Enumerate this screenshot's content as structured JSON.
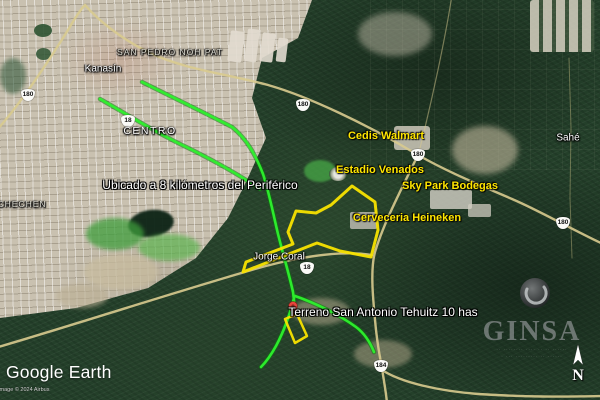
{
  "colors": {
    "route_green": "#2ef22e",
    "parcel_yellow": "#f8e300",
    "poi_label_yellow": "#ffe600",
    "road_tan": "#d9cb8f",
    "marker_red": "#e8453c"
  },
  "place_labels": [
    {
      "id": "san-pedro-noh-pat",
      "text": "SAN PEDRO NOH PAT"
    },
    {
      "id": "kanasin",
      "text": "Kanasín"
    },
    {
      "id": "centro",
      "text": "CENTRO"
    },
    {
      "id": "chechen",
      "text": "CHECHEN"
    },
    {
      "id": "sahe",
      "text": "Sahé"
    },
    {
      "id": "jorge-coral",
      "text": "Jorge Coral"
    }
  ],
  "poi_labels": [
    {
      "id": "cedis-walmart",
      "text": "Cedis Walmart"
    },
    {
      "id": "estadio-venados",
      "text": "Estadio Venados"
    },
    {
      "id": "sky-park-bodegas",
      "text": "Sky Park Bodegas"
    },
    {
      "id": "cerveceria-heineken",
      "text": "Cerveceria Heineken"
    }
  ],
  "annotations": [
    {
      "id": "periferico-note",
      "text": "Ubicado a 8 kilómetros del Periférico"
    },
    {
      "id": "terreno-note",
      "text": "Terreno San Antonio Tehuitz 10 has"
    }
  ],
  "road_shields": [
    {
      "route": "180"
    },
    {
      "route": "180"
    },
    {
      "route": "180"
    },
    {
      "route": "180"
    },
    {
      "route": "18"
    },
    {
      "route": "18"
    },
    {
      "route": "184"
    }
  ],
  "attribution": {
    "logo_text": "Google Earth",
    "imagery_credit": "Image © 2024 Airbus"
  },
  "watermark": {
    "brand": "GINSA",
    "tagline_line1": "·· ········ ···· ·· ·· ······",
    "tagline_line2": "· ··· ········· ·· ······",
    "north_label": "N"
  }
}
